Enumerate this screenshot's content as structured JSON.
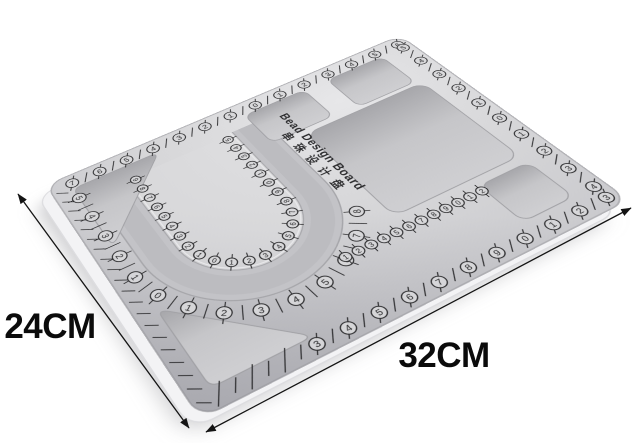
{
  "scene": {
    "background": "#ffffff",
    "description": "Gray flocked bead design board product photo with dimension arrows"
  },
  "board": {
    "title_en": "Bead Design Board",
    "title_zh": "串珠设计盘",
    "width_cm": "32",
    "height_cm": "24",
    "surface_color": "#d6d6d9",
    "recess_color": "#a9a9ad",
    "side_color": "#f3f3f5",
    "marking_color": "#2e2e30"
  },
  "dimension_labels": {
    "height": "24CM",
    "width": "32CM",
    "arrow_color": "#141414"
  },
  "rulers": {
    "rim_top": [
      7,
      6,
      5,
      4,
      3,
      2,
      1,
      0,
      1,
      2,
      3,
      4,
      5,
      6
    ],
    "rim_bottom": [
      null,
      null,
      null,
      3,
      4,
      5,
      6,
      7,
      8,
      9,
      0,
      1,
      2,
      3
    ],
    "rim_right": [
      5,
      4,
      3,
      2,
      1,
      0,
      1,
      2,
      3,
      4
    ],
    "rim_left_tick_count": 20,
    "outer_band": [
      5,
      4,
      3,
      2,
      1,
      0,
      1,
      2,
      3,
      4,
      5,
      6,
      7,
      8
    ],
    "island_band": [
      9,
      8,
      7,
      6,
      5,
      4,
      3,
      2,
      1,
      0,
      1,
      2,
      3,
      4,
      5,
      6,
      7,
      8,
      9,
      0,
      1,
      2,
      3,
      4,
      5
    ],
    "tray_band": [
      1,
      2,
      3,
      4,
      5,
      6,
      7,
      8,
      9,
      0,
      1,
      2
    ]
  }
}
